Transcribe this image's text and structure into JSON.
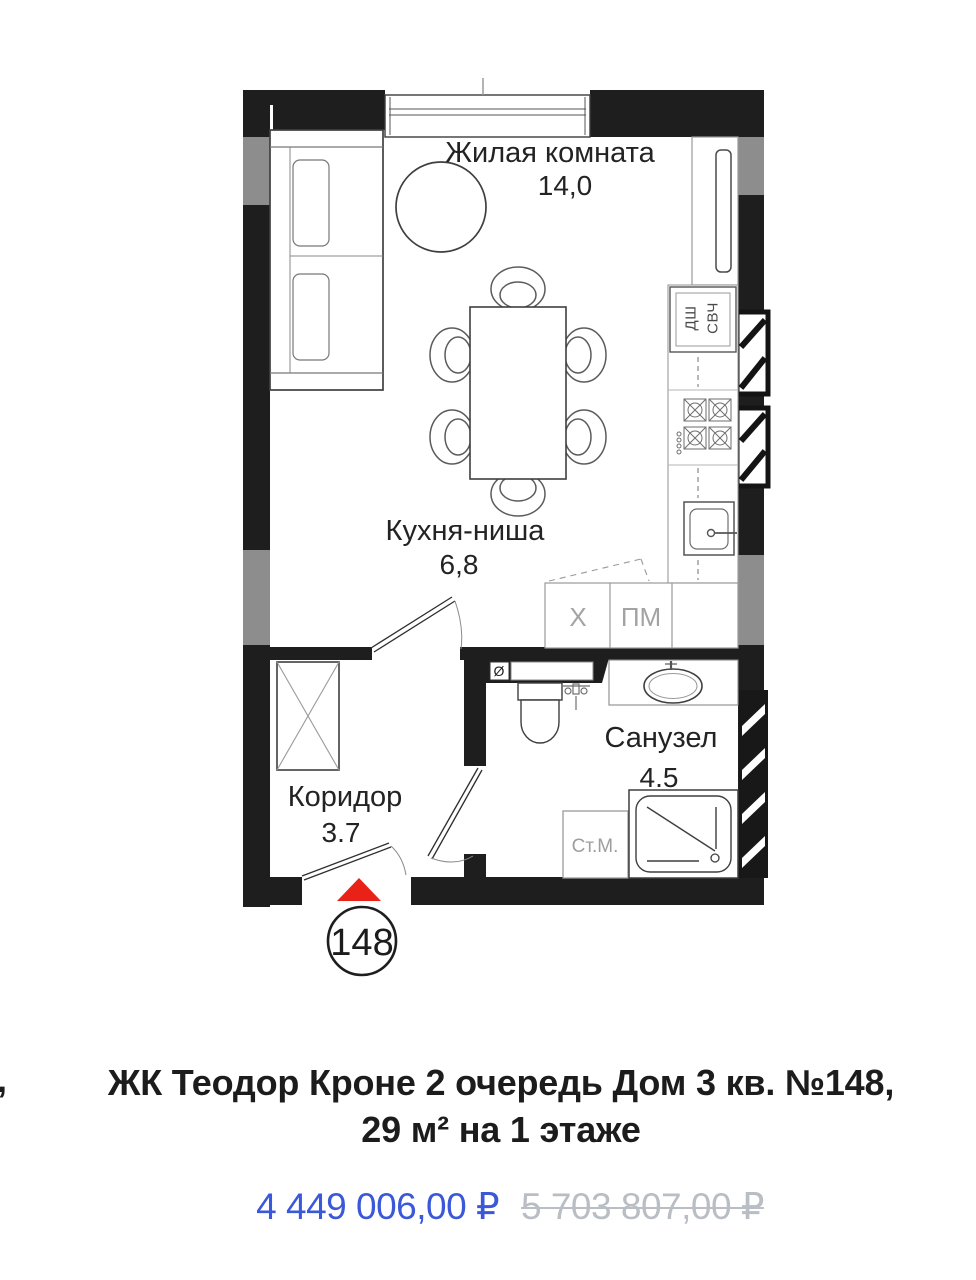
{
  "page": {
    "background": "#ffffff"
  },
  "floor_plan": {
    "badge_number": "148",
    "rooms": {
      "living": {
        "name": "Жилая комната",
        "area": "14,0"
      },
      "kitchen": {
        "name": "Кухня-ниша",
        "area": "6,8"
      },
      "corridor": {
        "name": "Коридор",
        "area": "3.7"
      },
      "bathroom": {
        "name": "Санузел",
        "area": "4.5"
      }
    },
    "appliances": {
      "dishwasher_column": "ДШ",
      "microwave_column": "СВЧ",
      "fridge": "X",
      "dishwasher": "ПМ",
      "washing_machine": "Ст.М.",
      "vent": "Ø"
    },
    "colors": {
      "wall": "#1e1e1e",
      "wall_accent_gray": "#8d8d8d",
      "entrance_marker_red": "#e92117"
    }
  },
  "listing": {
    "clipped_left_text": ",",
    "title_line1": "ЖК Теодор Кроне 2 очередь Дом 3 кв. №148,",
    "title_line2": "29 м² на 1 этаже",
    "price_current": "4 449 006,00 ₽",
    "price_old": "5 703 807,00 ₽",
    "price_current_color": "#3a58d8",
    "price_old_color": "#b9bdc4"
  }
}
